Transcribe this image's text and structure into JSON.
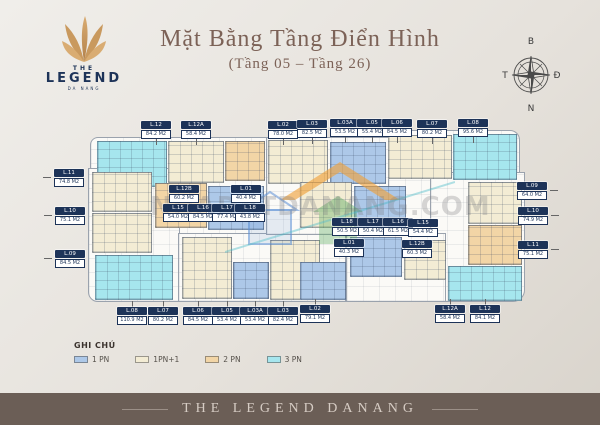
{
  "logo": {
    "top": "THE",
    "name": "LEGEND",
    "sub": "DA NANG"
  },
  "title": {
    "main": "Mặt Bằng Tầng Điển Hình",
    "sub": "(Tầng 05 – Tầng 26)"
  },
  "compass": {
    "north": "B",
    "east": "Đ",
    "south": "N",
    "west": "T"
  },
  "watermark": {
    "text": "NHADATDANANG.COM"
  },
  "legend": {
    "heading": "GHI CHÚ",
    "items": [
      {
        "label": "1 PN",
        "type": "1pn"
      },
      {
        "label": "1PN+1",
        "type": "1pn1"
      },
      {
        "label": "2 PN",
        "type": "2pn"
      },
      {
        "label": "3 PN",
        "type": "3pn"
      }
    ]
  },
  "footer": {
    "text": "THE LEGEND DANANG"
  },
  "plan": {
    "unit_colors": {
      "1pn": "#adc8e8",
      "1pn1": "#f3ecd4",
      "2pn": "#f2d5a6",
      "3pn": "#a6e6ee"
    },
    "blocks": [
      {
        "x": 97,
        "y": 141,
        "w": 70,
        "h": 46,
        "t": "3pn"
      },
      {
        "x": 168,
        "y": 141,
        "w": 56,
        "h": 42,
        "t": "1pn1"
      },
      {
        "x": 225,
        "y": 141,
        "w": 40,
        "h": 40,
        "t": "2pn"
      },
      {
        "x": 92,
        "y": 172,
        "w": 60,
        "h": 40,
        "t": "1pn1"
      },
      {
        "x": 92,
        "y": 213,
        "w": 60,
        "h": 40,
        "t": "1pn1"
      },
      {
        "x": 95,
        "y": 255,
        "w": 78,
        "h": 45,
        "t": "3pn"
      },
      {
        "x": 155,
        "y": 183,
        "w": 52,
        "h": 45,
        "t": "2pn"
      },
      {
        "x": 208,
        "y": 186,
        "w": 56,
        "h": 44,
        "t": "1pn"
      },
      {
        "x": 182,
        "y": 237,
        "w": 50,
        "h": 62,
        "t": "1pn1"
      },
      {
        "x": 233,
        "y": 262,
        "w": 36,
        "h": 37,
        "t": "1pn"
      },
      {
        "x": 270,
        "y": 240,
        "w": 50,
        "h": 60,
        "t": "1pn1"
      },
      {
        "x": 268,
        "y": 140,
        "w": 60,
        "h": 44,
        "t": "1pn1"
      },
      {
        "x": 330,
        "y": 142,
        "w": 56,
        "h": 42,
        "t": "1pn"
      },
      {
        "x": 388,
        "y": 135,
        "w": 64,
        "h": 44,
        "t": "1pn1"
      },
      {
        "x": 453,
        "y": 134,
        "w": 64,
        "h": 46,
        "t": "3pn"
      },
      {
        "x": 468,
        "y": 182,
        "w": 54,
        "h": 42,
        "t": "1pn1"
      },
      {
        "x": 468,
        "y": 225,
        "w": 54,
        "h": 40,
        "t": "2pn"
      },
      {
        "x": 448,
        "y": 266,
        "w": 74,
        "h": 35,
        "t": "3pn"
      },
      {
        "x": 350,
        "y": 237,
        "w": 52,
        "h": 40,
        "t": "1pn"
      },
      {
        "x": 404,
        "y": 240,
        "w": 42,
        "h": 40,
        "t": "1pn1"
      },
      {
        "x": 300,
        "y": 182,
        "w": 52,
        "h": 46,
        "t": "1pn1"
      },
      {
        "x": 354,
        "y": 186,
        "w": 52,
        "h": 42,
        "t": "1pn"
      },
      {
        "x": 300,
        "y": 262,
        "w": 46,
        "h": 38,
        "t": "1pn"
      }
    ],
    "labels": [
      {
        "id": "L.12",
        "area": "84.2 M2",
        "x": 156,
        "y": 129,
        "dir": "down"
      },
      {
        "id": "L.12A",
        "area": "58.4 M2",
        "x": 196,
        "y": 129,
        "dir": "down"
      },
      {
        "id": "L.02",
        "area": "78.0 M2",
        "x": 283,
        "y": 129,
        "dir": "down"
      },
      {
        "id": "L.03",
        "area": "82.5 M2",
        "x": 312,
        "y": 128,
        "dir": "down"
      },
      {
        "id": "L.03A",
        "area": "53.5 M2",
        "x": 345,
        "y": 127,
        "dir": "down"
      },
      {
        "id": "L.05",
        "area": "55.4 M2",
        "x": 372,
        "y": 127,
        "dir": "down"
      },
      {
        "id": "L.06",
        "area": "84.5 M2",
        "x": 397,
        "y": 127,
        "dir": "down"
      },
      {
        "id": "L.07",
        "area": "80.2 M2",
        "x": 432,
        "y": 128,
        "dir": "down"
      },
      {
        "id": "L.08",
        "area": "95.6 M2",
        "x": 473,
        "y": 127,
        "dir": "down"
      },
      {
        "id": "L.11",
        "area": "74.8 M2",
        "x": 69,
        "y": 177,
        "dir": "right"
      },
      {
        "id": "L.10",
        "area": "75.1 M2",
        "x": 70,
        "y": 215,
        "dir": "right"
      },
      {
        "id": "L.09",
        "area": "84.5 M2",
        "x": 70,
        "y": 258,
        "dir": "right"
      },
      {
        "id": "L.09",
        "area": "64.0 M2",
        "x": 532,
        "y": 190,
        "dir": "left"
      },
      {
        "id": "L.10",
        "area": "74.9 M2",
        "x": 533,
        "y": 215,
        "dir": "left"
      },
      {
        "id": "L.11",
        "area": "75.1 M2",
        "x": 533,
        "y": 249,
        "dir": "left"
      },
      {
        "id": "L.12B",
        "area": "60.2 M2",
        "x": 184,
        "y": 193,
        "dir": "none"
      },
      {
        "id": "L.01",
        "area": "40.4 M2",
        "x": 246,
        "y": 193,
        "dir": "none"
      },
      {
        "id": "L.15",
        "area": "54.0 M2",
        "x": 178,
        "y": 212,
        "dir": "none"
      },
      {
        "id": "L.16",
        "area": "84.5 M2",
        "x": 203,
        "y": 212,
        "dir": "none"
      },
      {
        "id": "L.17",
        "area": "77.4 M2",
        "x": 227,
        "y": 212,
        "dir": "none"
      },
      {
        "id": "L.18",
        "area": "43.8 M2",
        "x": 250,
        "y": 212,
        "dir": "none"
      },
      {
        "id": "L.18",
        "area": "50.5 M2",
        "x": 347,
        "y": 226,
        "dir": "none"
      },
      {
        "id": "L.17",
        "area": "50.4 M2",
        "x": 373,
        "y": 226,
        "dir": "none"
      },
      {
        "id": "L.16",
        "area": "61.5 M2",
        "x": 398,
        "y": 226,
        "dir": "none"
      },
      {
        "id": "L.15",
        "area": "54.4 M2",
        "x": 423,
        "y": 227,
        "dir": "none"
      },
      {
        "id": "L.01",
        "area": "40.3 M2",
        "x": 349,
        "y": 247,
        "dir": "none"
      },
      {
        "id": "L.12B",
        "area": "60.3 M2",
        "x": 417,
        "y": 248,
        "dir": "none"
      },
      {
        "id": "L.08",
        "area": "110.9 M2",
        "x": 132,
        "y": 316,
        "dir": "up"
      },
      {
        "id": "L.07",
        "area": "80.2 M2",
        "x": 163,
        "y": 316,
        "dir": "up"
      },
      {
        "id": "L.06",
        "area": "84.5 M2",
        "x": 198,
        "y": 316,
        "dir": "up"
      },
      {
        "id": "L.05",
        "area": "53.4 M2",
        "x": 227,
        "y": 316,
        "dir": "up"
      },
      {
        "id": "L.03A",
        "area": "53.4 M2",
        "x": 255,
        "y": 316,
        "dir": "up"
      },
      {
        "id": "L.03",
        "area": "82.4 M2",
        "x": 283,
        "y": 316,
        "dir": "up"
      },
      {
        "id": "L.02",
        "area": "79.1 M2",
        "x": 315,
        "y": 314,
        "dir": "up"
      },
      {
        "id": "L.12A",
        "area": "58.4 M2",
        "x": 450,
        "y": 314,
        "dir": "up"
      },
      {
        "id": "L.12",
        "area": "84.1 M2",
        "x": 485,
        "y": 314,
        "dir": "up"
      }
    ]
  }
}
